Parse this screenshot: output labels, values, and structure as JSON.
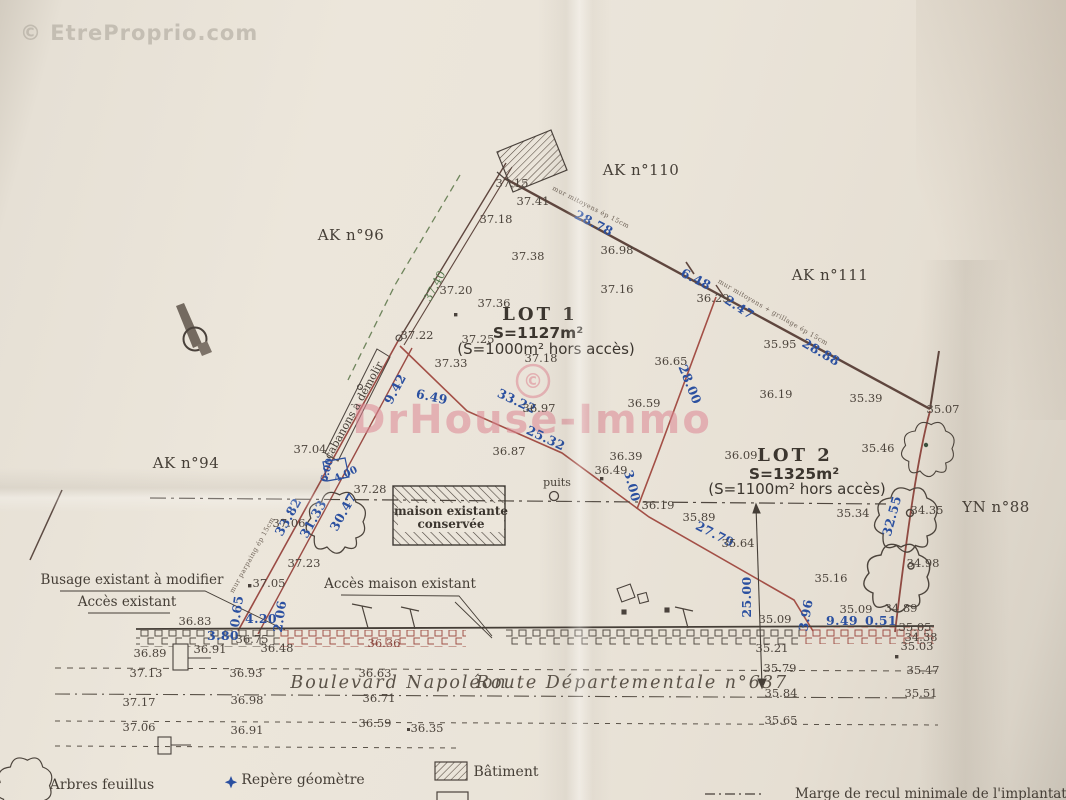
{
  "watermarks": {
    "corner": "© EtreProprio.com",
    "center_symbol": "©",
    "center": "DrHouse-Immo"
  },
  "parcels": [
    "AK n°96",
    "AK n°110",
    "AK n°111",
    "AK n°94",
    "YN n°88"
  ],
  "lots": [
    {
      "name": "LOT 1",
      "area": "S=1127m²",
      "area_excl": "(S=1000m² hors accès)"
    },
    {
      "name": "LOT 2",
      "area": "S=1325m²",
      "area_excl": "(S=1100m² hors accès)"
    }
  ],
  "roads": [
    "Boulevard Napoléon",
    "Route Départementale n°637"
  ],
  "legend": [
    {
      "symbol": "deciduous-tree-icon",
      "label": "Arbres feuillus"
    },
    {
      "symbol": "survey-marker-star-icon",
      "label": "Repère géomètre"
    },
    {
      "symbol": "hatched-building-swatch",
      "label": "Bâtiment"
    },
    {
      "symbol": "dash-dot-line-swatch",
      "label": "Marge de recul minimale de l'implantation des constructions"
    }
  ],
  "annotations": [
    "Busage existant à modifier",
    "Accès existant",
    "Accès maison existant",
    "cabanons à démolir",
    "maison existante conservée",
    "puits",
    "mur mitoyens ép 15cm",
    "mur mitoyens + grillage ép 15cm",
    "mur parpaing ép 15cm"
  ],
  "colors": {
    "measure_blue": "#2b50a0",
    "boundary_red": "#a34f46",
    "ink": "#4c443c",
    "watermark_pink": "#dd8794",
    "paper": "#ece6db"
  },
  "plan_labels": [
    {
      "t": "© EtreProprio.com",
      "x": 20,
      "y": 40,
      "a": "start",
      "c": "wm-gray",
      "n": "watermark-etreproprio"
    },
    {
      "t": "©",
      "x": 533,
      "y": 388,
      "c": "wm-pink-c",
      "n": "watermark-copyright-symbol"
    },
    {
      "t": "DrHouse-Immo",
      "x": 532,
      "y": 433,
      "c": "wm-pink",
      "n": "watermark-drhouse-immo"
    },
    {
      "t": "AK n°96",
      "x": 351,
      "y": 240,
      "c": "parcel",
      "n": "parcel-ak96"
    },
    {
      "t": "AK n°110",
      "x": 641,
      "y": 175,
      "c": "parcel",
      "n": "parcel-ak110"
    },
    {
      "t": "AK n°111",
      "x": 830,
      "y": 280,
      "c": "parcel",
      "n": "parcel-ak111"
    },
    {
      "t": "AK n°94",
      "x": 186,
      "y": 468,
      "c": "parcel",
      "n": "parcel-ak94"
    },
    {
      "t": "YN n°88",
      "x": 996,
      "y": 512,
      "c": "parcel",
      "n": "parcel-yn88"
    },
    {
      "t": "LOT 1",
      "x": 540,
      "y": 320,
      "c": "lot",
      "n": "lot1-title"
    },
    {
      "t": "S=1127m²",
      "x": 538,
      "y": 338,
      "c": "area",
      "n": "lot1-area"
    },
    {
      "t": "(S=1000m² hors accès)",
      "x": 546,
      "y": 354,
      "c": "area2",
      "n": "lot1-area-excl"
    },
    {
      "t": "LOT 2",
      "x": 795,
      "y": 461,
      "c": "lot",
      "n": "lot2-title"
    },
    {
      "t": "S=1325m²",
      "x": 794,
      "y": 479,
      "c": "area",
      "n": "lot2-area"
    },
    {
      "t": "(S=1100m² hors accès)",
      "x": 797,
      "y": 494,
      "c": "area2",
      "n": "lot2-area-excl"
    },
    {
      "t": "Boulevard Napoléon",
      "x": 399,
      "y": 688,
      "c": "road",
      "n": "road-boulevard-napoleon"
    },
    {
      "t": "Route Départementale n°637",
      "x": 632,
      "y": 688,
      "c": "road",
      "n": "road-departementale-637"
    },
    {
      "t": "Busage existant à modifier",
      "x": 132,
      "y": 584,
      "c": "note",
      "n": "note-busage"
    },
    {
      "t": "Accès existant",
      "x": 127,
      "y": 606,
      "c": "note",
      "n": "note-acces-existant"
    },
    {
      "t": "Accès maison existant",
      "x": 400,
      "y": 588,
      "c": "note",
      "n": "note-acces-maison"
    },
    {
      "t": "cabanons à démolir",
      "x": 357,
      "y": 412,
      "r": -61,
      "c": "note-sm",
      "n": "note-cabanons"
    },
    {
      "t": "maison existante",
      "x": 451,
      "y": 515,
      "c": "note-b",
      "n": "note-maison-1"
    },
    {
      "t": "conservée",
      "x": 451,
      "y": 528,
      "c": "note-b",
      "n": "note-maison-2"
    },
    {
      "t": "puits",
      "x": 557,
      "y": 486,
      "c": "note-sm",
      "n": "note-puits"
    },
    {
      "t": "mur mitoyens ép 15cm",
      "x": 590,
      "y": 209,
      "r": 27,
      "c": "tiny",
      "n": "note-mur-1"
    },
    {
      "t": "mur mitoyens + grillage ép 15cm",
      "x": 772,
      "y": 314,
      "r": 30,
      "c": "tiny",
      "n": "note-mur-2"
    },
    {
      "t": "mur parpaing ép 15cm",
      "x": 254,
      "y": 556,
      "r": -61,
      "c": "tiny",
      "n": "note-mur-3"
    },
    {
      "t": "Arbres feuillus",
      "x": 102,
      "y": 789,
      "c": "note14",
      "n": "legend-arbres"
    },
    {
      "t": "Repère géomètre",
      "x": 303,
      "y": 784,
      "c": "note14",
      "n": "legend-repere"
    },
    {
      "t": "Bâtiment",
      "x": 506,
      "y": 776,
      "c": "note14",
      "n": "legend-batiment"
    },
    {
      "t": "Marge de recul minimale de l'implantation des constructions",
      "x": 795,
      "y": 798,
      "a": "start",
      "c": "note",
      "n": "legend-marge"
    },
    {
      "t": "28.78",
      "x": 592,
      "y": 227,
      "r": 27,
      "c": "blue"
    },
    {
      "t": "6.48",
      "x": 694,
      "y": 283,
      "r": 27,
      "c": "blue"
    },
    {
      "t": "2.47",
      "x": 737,
      "y": 311,
      "r": 33,
      "c": "blue"
    },
    {
      "t": "28.88",
      "x": 819,
      "y": 356,
      "r": 30,
      "c": "blue"
    },
    {
      "t": "28.00",
      "x": 686,
      "y": 386,
      "r": 68,
      "c": "blue"
    },
    {
      "t": "3.00",
      "x": 628,
      "y": 487,
      "r": 75,
      "c": "blue"
    },
    {
      "t": "25.32",
      "x": 544,
      "y": 442,
      "r": 25,
      "c": "blue"
    },
    {
      "t": "33.22",
      "x": 515,
      "y": 405,
      "r": 25,
      "c": "blue"
    },
    {
      "t": "6.49",
      "x": 431,
      "y": 401,
      "r": 12,
      "c": "blue"
    },
    {
      "t": "9.42",
      "x": 399,
      "y": 391,
      "r": -62,
      "c": "blue"
    },
    {
      "t": "33.82",
      "x": 292,
      "y": 519,
      "r": -61,
      "c": "blue"
    },
    {
      "t": "31.33",
      "x": 317,
      "y": 521,
      "r": -61,
      "c": "blue"
    },
    {
      "t": "30.47",
      "x": 347,
      "y": 514,
      "r": -61,
      "c": "blue"
    },
    {
      "t": "0.65",
      "x": 241,
      "y": 612,
      "r": -82,
      "c": "blue"
    },
    {
      "t": "4.20",
      "x": 261,
      "y": 623,
      "c": "blue"
    },
    {
      "t": "2.06",
      "x": 284,
      "y": 617,
      "r": -82,
      "c": "blue"
    },
    {
      "t": "3.80",
      "x": 223,
      "y": 640,
      "c": "blue"
    },
    {
      "t": "27.79",
      "x": 713,
      "y": 538,
      "r": 27,
      "c": "blue"
    },
    {
      "t": "25.00",
      "x": 751,
      "y": 597,
      "r": -90,
      "c": "blue"
    },
    {
      "t": "3.96",
      "x": 810,
      "y": 616,
      "r": -80,
      "c": "blue"
    },
    {
      "t": "9.49",
      "x": 842,
      "y": 625,
      "c": "blue"
    },
    {
      "t": "0.51",
      "x": 881,
      "y": 625,
      "c": "blue"
    },
    {
      "t": "32.55",
      "x": 896,
      "y": 517,
      "r": -75,
      "c": "blue"
    },
    {
      "t": "6.00",
      "x": 330,
      "y": 471,
      "r": -75,
      "c": "blue-sm"
    },
    {
      "t": "4.00",
      "x": 347,
      "y": 477,
      "r": -25,
      "c": "blue-sm"
    },
    {
      "t": "37.15",
      "x": 512,
      "y": 187
    },
    {
      "t": "37.41",
      "x": 533,
      "y": 205
    },
    {
      "t": "37.18",
      "x": 496,
      "y": 223
    },
    {
      "t": "37.38",
      "x": 528,
      "y": 260
    },
    {
      "t": "37.20",
      "x": 456,
      "y": 294
    },
    {
      "t": "37.40",
      "x": 438,
      "y": 288,
      "r": -62,
      "c": "green"
    },
    {
      "t": "37.36",
      "x": 494,
      "y": 307
    },
    {
      "t": "36.98",
      "x": 617,
      "y": 254
    },
    {
      "t": "37.16",
      "x": 617,
      "y": 293
    },
    {
      "t": "36.29",
      "x": 713,
      "y": 302
    },
    {
      "t": "35.95",
      "x": 780,
      "y": 348
    },
    {
      "t": "36.19",
      "x": 776,
      "y": 398
    },
    {
      "t": "35.39",
      "x": 866,
      "y": 402
    },
    {
      "t": "35.07",
      "x": 943,
      "y": 413
    },
    {
      "t": "37.22",
      "x": 417,
      "y": 339
    },
    {
      "t": "37.25",
      "x": 478,
      "y": 343
    },
    {
      "t": "37.33",
      "x": 451,
      "y": 367
    },
    {
      "t": "37.18",
      "x": 541,
      "y": 362
    },
    {
      "t": "36.65",
      "x": 671,
      "y": 365
    },
    {
      "t": "36.59",
      "x": 644,
      "y": 407
    },
    {
      "t": "36.97",
      "x": 539,
      "y": 412
    },
    {
      "t": "36.87",
      "x": 509,
      "y": 455
    },
    {
      "t": "36.39",
      "x": 626,
      "y": 460
    },
    {
      "t": "36.49",
      "x": 611,
      "y": 474
    },
    {
      "t": "36.09",
      "x": 741,
      "y": 459
    },
    {
      "t": "35.46",
      "x": 878,
      "y": 452
    },
    {
      "t": "37.04",
      "x": 310,
      "y": 453
    },
    {
      "t": "37.06",
      "x": 289,
      "y": 527
    },
    {
      "t": "37.28",
      "x": 370,
      "y": 493
    },
    {
      "t": "37.23",
      "x": 304,
      "y": 567
    },
    {
      "t": "37.05",
      "x": 269,
      "y": 587
    },
    {
      "t": "36.19",
      "x": 658,
      "y": 509
    },
    {
      "t": "35.89",
      "x": 699,
      "y": 521
    },
    {
      "t": "35.64",
      "x": 738,
      "y": 547
    },
    {
      "t": "35.34",
      "x": 853,
      "y": 517
    },
    {
      "t": "34.35",
      "x": 927,
      "y": 514
    },
    {
      "t": "34.98",
      "x": 923,
      "y": 567
    },
    {
      "t": "35.16",
      "x": 831,
      "y": 582
    },
    {
      "t": "35.09",
      "x": 856,
      "y": 613
    },
    {
      "t": "34.89",
      "x": 901,
      "y": 612
    },
    {
      "t": "35.09",
      "x": 775,
      "y": 623
    },
    {
      "t": "35.21",
      "x": 772,
      "y": 652
    },
    {
      "t": "35.05",
      "x": 915,
      "y": 631
    },
    {
      "t": "34.38",
      "x": 921,
      "y": 641
    },
    {
      "t": "35.03",
      "x": 917,
      "y": 650
    },
    {
      "t": "35.47",
      "x": 923,
      "y": 674
    },
    {
      "t": "35.79",
      "x": 780,
      "y": 672
    },
    {
      "t": "35.84",
      "x": 781,
      "y": 697
    },
    {
      "t": "35.51",
      "x": 921,
      "y": 697
    },
    {
      "t": "35.65",
      "x": 781,
      "y": 724
    },
    {
      "t": "36.83",
      "x": 195,
      "y": 625
    },
    {
      "t": "36.89",
      "x": 150,
      "y": 657
    },
    {
      "t": "36.91",
      "x": 210,
      "y": 653
    },
    {
      "t": "36.75",
      "x": 252,
      "y": 643
    },
    {
      "t": "36.48",
      "x": 277,
      "y": 652
    },
    {
      "t": "36.36",
      "x": 384,
      "y": 647,
      "c": "redt"
    },
    {
      "t": "36.63",
      "x": 375,
      "y": 677
    },
    {
      "t": "36.93",
      "x": 246,
      "y": 677
    },
    {
      "t": "37.13",
      "x": 146,
      "y": 677
    },
    {
      "t": "36.71",
      "x": 379,
      "y": 702
    },
    {
      "t": "36.98",
      "x": 247,
      "y": 704
    },
    {
      "t": "37.17",
      "x": 139,
      "y": 706
    },
    {
      "t": "36.59",
      "x": 375,
      "y": 727
    },
    {
      "t": "36.35",
      "x": 427,
      "y": 732
    },
    {
      "t": "36.91",
      "x": 247,
      "y": 734
    },
    {
      "t": "37.06",
      "x": 139,
      "y": 731
    }
  ]
}
